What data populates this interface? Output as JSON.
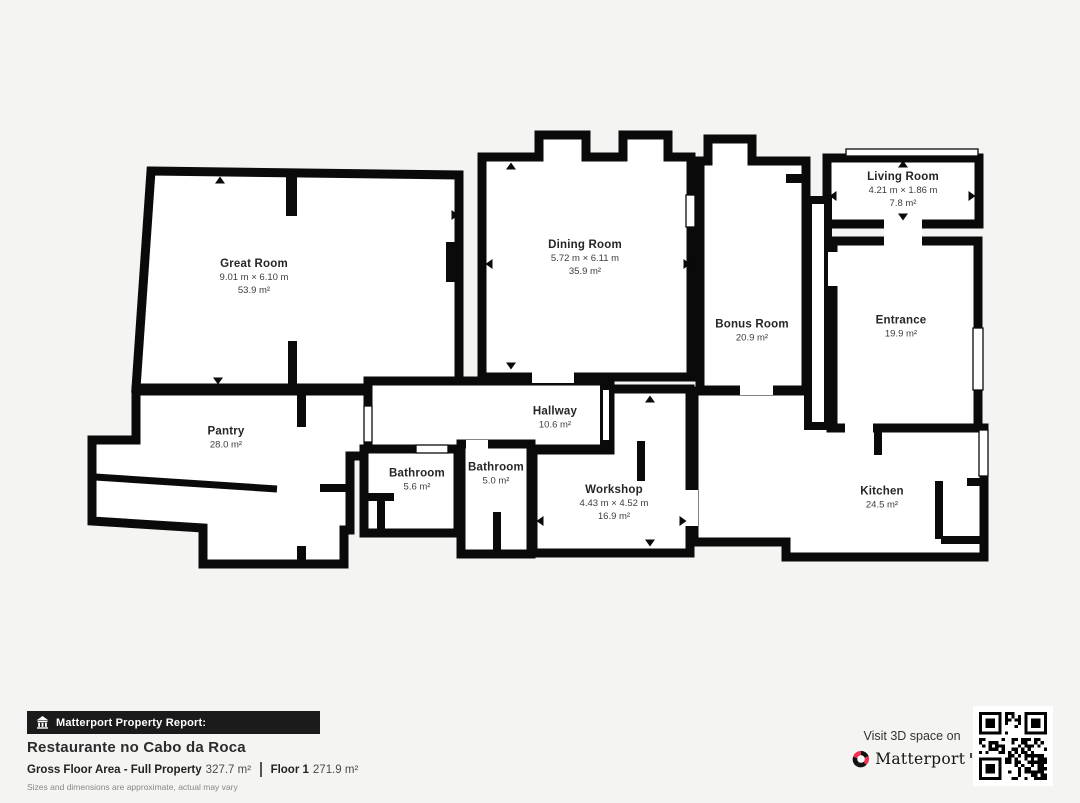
{
  "rooms": [
    {
      "id": "great-room",
      "name": "Great Room",
      "dimensions": "9.01 m × 6.10 m",
      "area": "53.9 m²"
    },
    {
      "id": "dining-room",
      "name": "Dining Room",
      "dimensions": "5.72 m × 6.11 m",
      "area": "35.9 m²"
    },
    {
      "id": "living-room",
      "name": "Living Room",
      "dimensions": "4.21 m × 1.86 m",
      "area": "7.8 m²"
    },
    {
      "id": "bonus-room",
      "name": "Bonus Room",
      "dimensions": "",
      "area": "20.9 m²"
    },
    {
      "id": "entrance",
      "name": "Entrance",
      "dimensions": "",
      "area": "19.9 m²"
    },
    {
      "id": "pantry",
      "name": "Pantry",
      "dimensions": "",
      "area": "28.0 m²"
    },
    {
      "id": "hallway",
      "name": "Hallway",
      "dimensions": "",
      "area": "10.6 m²"
    },
    {
      "id": "bathroom-1",
      "name": "Bathroom",
      "dimensions": "",
      "area": "5.6 m²"
    },
    {
      "id": "bathroom-2",
      "name": "Bathroom",
      "dimensions": "",
      "area": "5.0 m²"
    },
    {
      "id": "workshop",
      "name": "Workshop",
      "dimensions": "4.43 m × 4.52 m",
      "area": "16.9 m²"
    },
    {
      "id": "kitchen",
      "name": "Kitchen",
      "dimensions": "",
      "area": "24.5 m²"
    }
  ],
  "footer": {
    "report_label": "Matterport Property Report:",
    "property_name": "Restaurante no Cabo da Roca",
    "gross_label": "Gross Floor Area - Full Property",
    "gross_value": "327.7 m²",
    "floor_label": "Floor 1",
    "floor_value": "271.9 m²",
    "disclaimer": "Sizes and dimensions are approximate, actual may vary",
    "visit_text": "Visit 3D space on",
    "brand": "Matterport"
  },
  "colors": {
    "background": "#f4f4f2",
    "wall": "#0a0a0a",
    "room_fill": "#ffffff",
    "brand_red": "#ef2e50",
    "footer_bar": "#1b1b1b"
  }
}
